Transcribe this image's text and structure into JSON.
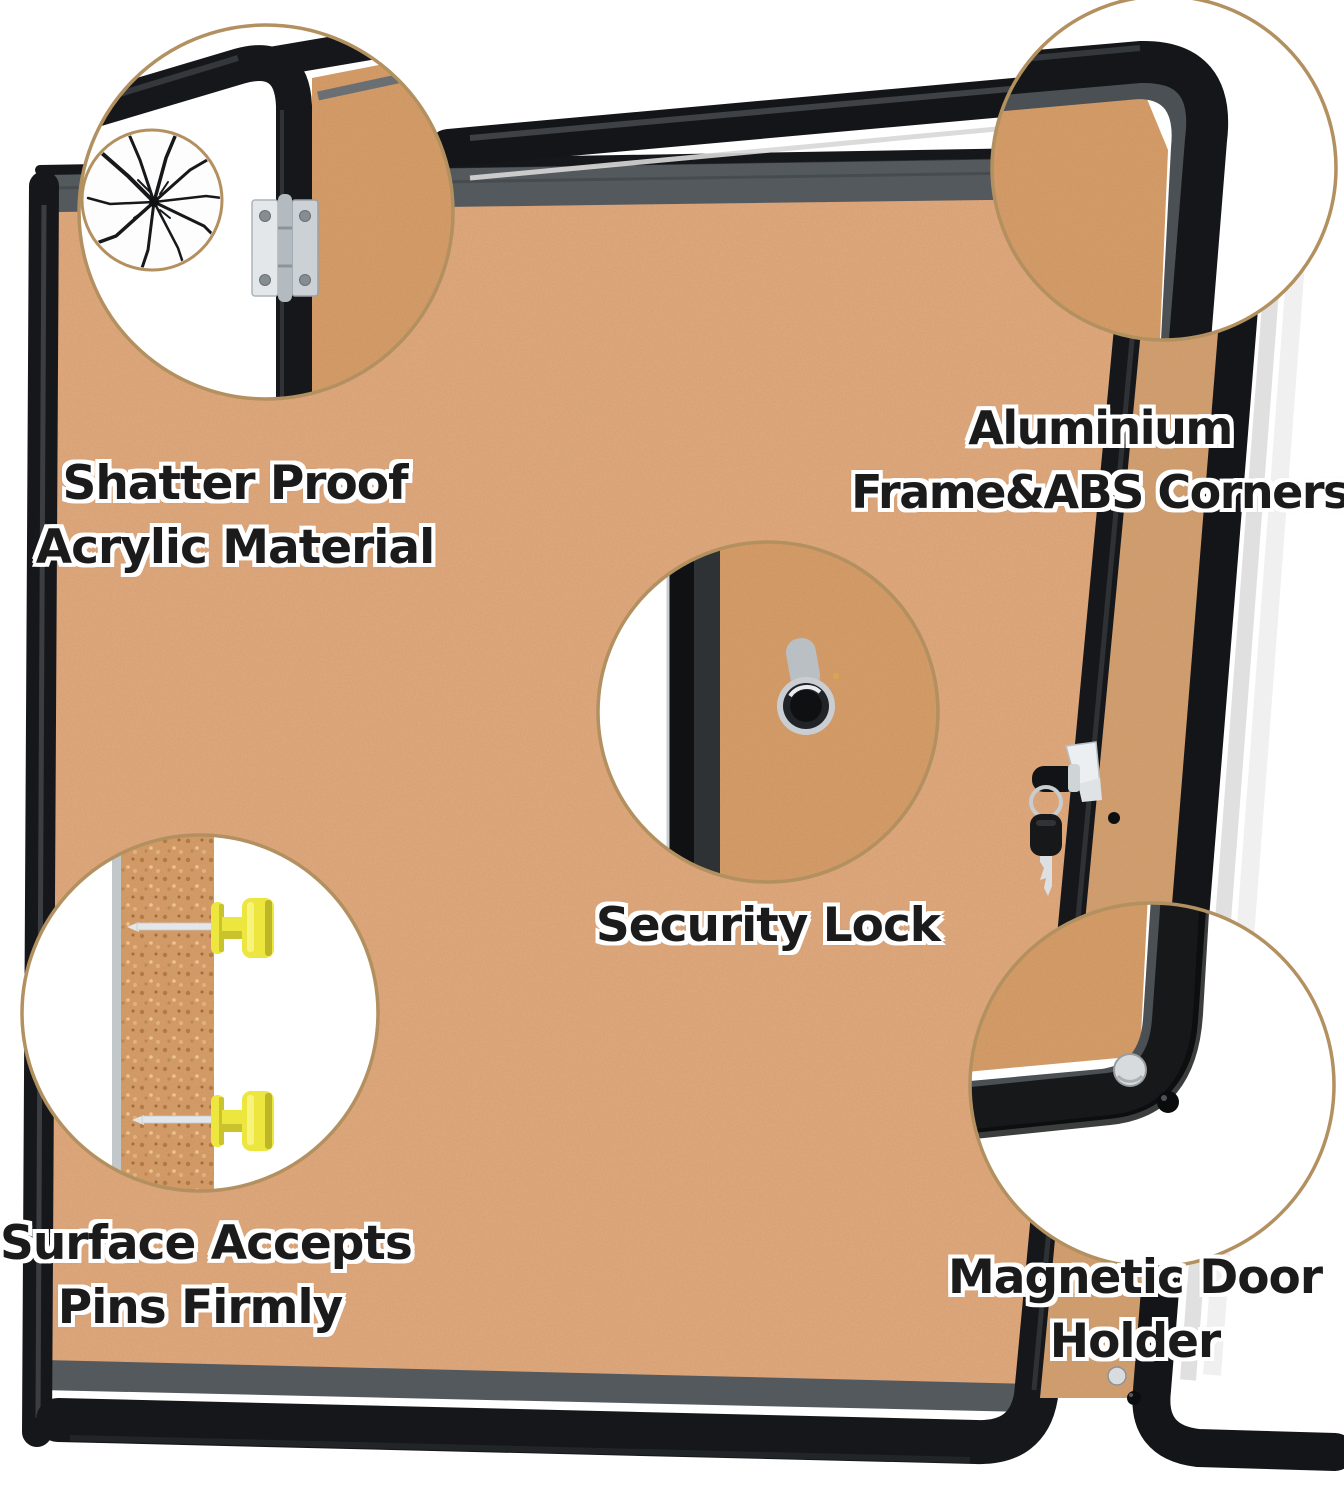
{
  "colors": {
    "cork": "#dca57a",
    "cork_deep": "#d29a66",
    "frame_black": "#16171a",
    "frame_gray": "#54595e",
    "circle_border": "#b3905f",
    "pin_yellow": "#ece63f",
    "text_black": "#1b1b1b",
    "text_outline": "#ffffff"
  },
  "callouts": {
    "shatter": {
      "line1": "Shatter Proof",
      "line2": "Acrylic Material"
    },
    "aluminium": {
      "line1": "Aluminium",
      "line2": "Frame&ABS Corners"
    },
    "security": {
      "line1": "Security Lock"
    },
    "pins": {
      "line1": "Surface Accepts",
      "line2": "Pins Firmly"
    },
    "magnetic": {
      "line1": "Magnetic Door",
      "line2": "Holder"
    }
  }
}
